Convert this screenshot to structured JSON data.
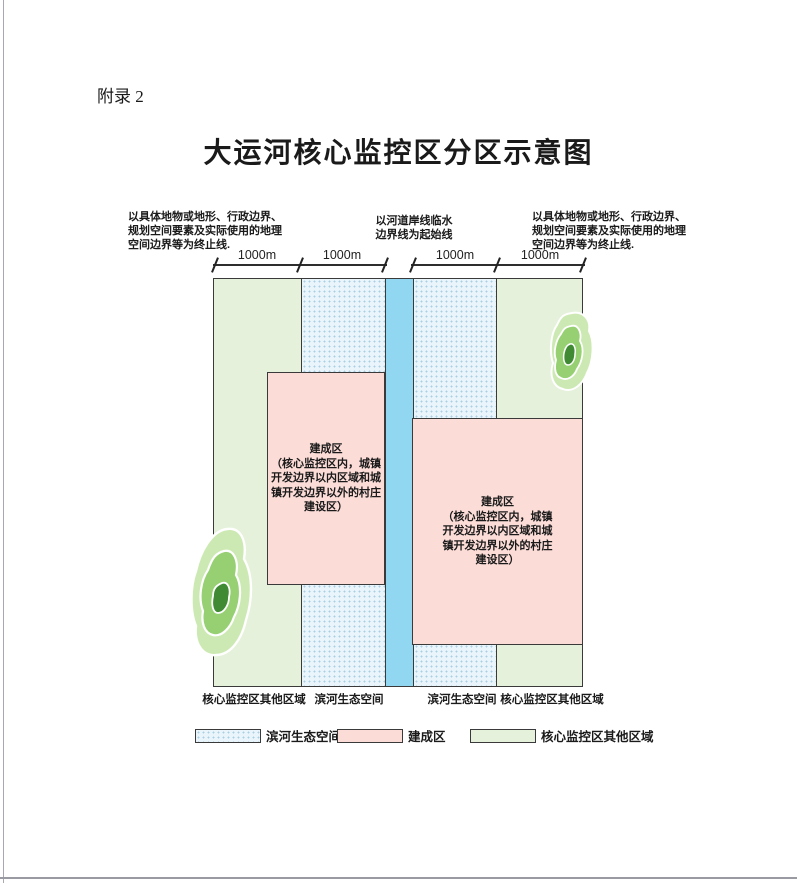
{
  "page": {
    "appendix_label": "附录 2",
    "title": "大运河核心监控区分区示意图"
  },
  "diagram": {
    "annotation_left": "以具体地物或地形、行政边界、\n规划空间要素及实际使用的地理\n空间边界等为终止线.",
    "annotation_center": "以河道岸线临水\n边界线为起始线",
    "annotation_right": "以具体地物或地形、行政边界、\n规划空间要素及实际使用的地理\n空间边界等为终止线.",
    "dimension_labels": [
      "1000m",
      "1000m",
      "1000m",
      "1000m"
    ],
    "built_area_text": "建成区\n（核心监控区内，城镇\n开发边界以内区域和城\n镇开发边界以外的村庄\n建设区）",
    "zone_labels": [
      "核心监控区其他区域",
      "滨河生态空间",
      "滨河生态空间",
      "核心监控区其他区域"
    ]
  },
  "legend": {
    "items": [
      {
        "label": "滨河生态空间"
      },
      {
        "label": "建成区"
      },
      {
        "label": "核心监控区其他区域"
      }
    ]
  },
  "colors": {
    "river": "#92d7f2",
    "eco_background": "#eaf4fb",
    "eco_dots": "#a9cfe3",
    "built_area": "#fbdcd7",
    "other_area": "#e5f1da",
    "zone_border": "#3a3a3a",
    "terrain_outer": "#cde9b3",
    "terrain_middle": "#96d073",
    "terrain_core": "#3f8a33"
  }
}
